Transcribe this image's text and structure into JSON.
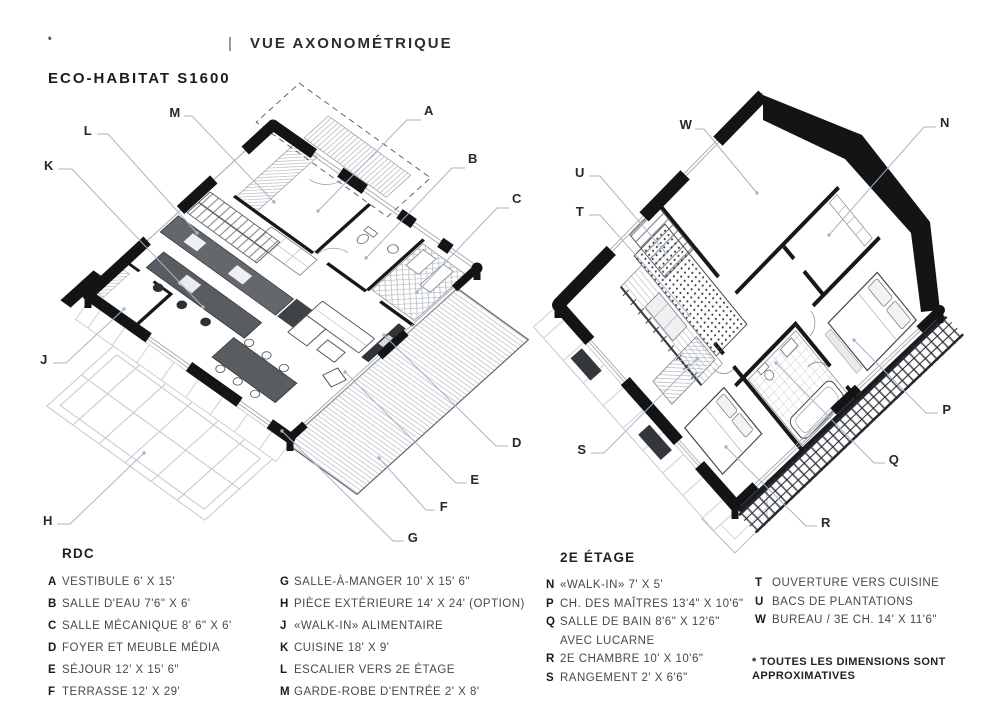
{
  "header": {
    "brand": "ECO-HABITAT S1600",
    "brand_sup": "*",
    "divider": "|",
    "view": "VUE AXONOMÉTRIQUE"
  },
  "captions": {
    "left": "RDC",
    "right": "2E ÉTAGE"
  },
  "legend": {
    "columns": [
      {
        "items": [
          {
            "k": "A",
            "t": "VESTIBULE 6' X 15'"
          },
          {
            "k": "B",
            "t": "SALLE D'EAU 7'6\" X 6'"
          },
          {
            "k": "C",
            "t": "SALLE MÉCANIQUE 8' 6\" X 6'"
          },
          {
            "k": "D",
            "t": "FOYER ET MEUBLE MÉDIA"
          },
          {
            "k": "E",
            "t": "SÉJOUR 12' X 15' 6\""
          },
          {
            "k": "F",
            "t": "TERRASSE 12' X 29'"
          }
        ]
      },
      {
        "items": [
          {
            "k": "G",
            "t": "SALLE-À-MANGER 10' X 15' 6\""
          },
          {
            "k": "H",
            "t": "PIÈCE EXTÉRIEURE 14' X 24' (OPTION)"
          },
          {
            "k": "J",
            "t": "«WALK-IN» ALIMENTAIRE"
          },
          {
            "k": "K",
            "t": "CUISINE 18' X 9'"
          },
          {
            "k": "L",
            "t": "ESCALIER VERS 2E ÉTAGE"
          },
          {
            "k": "M",
            "t": "GARDE-ROBE D'ENTRÉE 2' X 8'"
          }
        ]
      },
      {
        "items": [
          {
            "k": "N",
            "t": "«WALK-IN» 7' X 5'"
          },
          {
            "k": "P",
            "t": "CH. DES MAÎTRES 13'4\" X 10'6\""
          },
          {
            "k": "Q",
            "t": "SALLE DE BAIN 8'6\" X 12'6\""
          },
          {
            "k": "",
            "t": "AVEC LUCARNE"
          },
          {
            "k": "R",
            "t": "2E CHAMBRE 10' X 10'6\""
          },
          {
            "k": "S",
            "t": "RANGEMENT 2' X 6'6\""
          }
        ]
      },
      {
        "items": [
          {
            "k": "T",
            "t": "OUVERTURE VERS CUISINE"
          },
          {
            "k": "U",
            "t": "BACS DE PLANTATIONS"
          },
          {
            "k": "W",
            "t": "BUREAU / 3E CH. 14' X 11'6\""
          }
        ]
      }
    ]
  },
  "footnote": {
    "line1": "* TOUTES LES DIMENSIONS SONT",
    "line2": "APPROXIMATIVES"
  },
  "colors": {
    "leader": "#a7b5c8",
    "wall": "#131416",
    "furniture": "#5c6064"
  },
  "labels": {
    "left": [
      {
        "letter": "A",
        "label": [
          429,
          111
        ],
        "line": [
          [
            421,
            120
          ],
          [
            407,
            120
          ],
          [
            318,
            211
          ]
        ]
      },
      {
        "letter": "B",
        "label": [
          473,
          159
        ],
        "line": [
          [
            465,
            168
          ],
          [
            452,
            168
          ],
          [
            366,
            258
          ]
        ]
      },
      {
        "letter": "C",
        "label": [
          517,
          199
        ],
        "line": [
          [
            509,
            208
          ],
          [
            497,
            208
          ],
          [
            417,
            292
          ]
        ]
      },
      {
        "letter": "D",
        "label": [
          517,
          443
        ],
        "line": [
          [
            508,
            446
          ],
          [
            496,
            446
          ],
          [
            384,
            335
          ]
        ]
      },
      {
        "letter": "E",
        "label": [
          475,
          480
        ],
        "line": [
          [
            466,
            483
          ],
          [
            456,
            483
          ],
          [
            345,
            372
          ]
        ]
      },
      {
        "letter": "F",
        "label": [
          444,
          507
        ],
        "line": [
          [
            435,
            510
          ],
          [
            426,
            510
          ],
          [
            379,
            458
          ]
        ]
      },
      {
        "letter": "G",
        "label": [
          413,
          538
        ],
        "line": [
          [
            404,
            541
          ],
          [
            393,
            541
          ],
          [
            282,
            431
          ]
        ]
      },
      {
        "letter": "H",
        "label": [
          48,
          521
        ],
        "line": [
          [
            57,
            524
          ],
          [
            70,
            524
          ],
          [
            144,
            453
          ]
        ]
      },
      {
        "letter": "J",
        "label": [
          44,
          360
        ],
        "line": [
          [
            53,
            363
          ],
          [
            66,
            363
          ],
          [
            124,
            309
          ]
        ]
      },
      {
        "letter": "K",
        "label": [
          49,
          166
        ],
        "line": [
          [
            58,
            169
          ],
          [
            72,
            169
          ],
          [
            203,
            307
          ]
        ]
      },
      {
        "letter": "L",
        "label": [
          88,
          131
        ],
        "line": [
          [
            97,
            134
          ],
          [
            108,
            134
          ],
          [
            197,
            233
          ]
        ]
      },
      {
        "letter": "M",
        "label": [
          175,
          113
        ],
        "line": [
          [
            184,
            116
          ],
          [
            192,
            116
          ],
          [
            274,
            202
          ]
        ]
      }
    ],
    "right": [
      {
        "letter": "N",
        "label": [
          945,
          123
        ],
        "line": [
          [
            936,
            127
          ],
          [
            924,
            127
          ],
          [
            829,
            235
          ]
        ]
      },
      {
        "letter": "P",
        "label": [
          947,
          410
        ],
        "line": [
          [
            938,
            413
          ],
          [
            926,
            413
          ],
          [
            854,
            340
          ]
        ]
      },
      {
        "letter": "Q",
        "label": [
          894,
          460
        ],
        "line": [
          [
            885,
            463
          ],
          [
            874,
            463
          ],
          [
            776,
            363
          ]
        ]
      },
      {
        "letter": "R",
        "label": [
          826,
          523
        ],
        "line": [
          [
            817,
            526
          ],
          [
            806,
            526
          ],
          [
            726,
            447
          ]
        ]
      },
      {
        "letter": "S",
        "label": [
          582,
          450
        ],
        "line": [
          [
            591,
            453
          ],
          [
            604,
            453
          ],
          [
            697,
            359
          ]
        ]
      },
      {
        "letter": "T",
        "label": [
          580,
          212
        ],
        "line": [
          [
            589,
            215
          ],
          [
            600,
            215
          ],
          [
            689,
            315
          ]
        ]
      },
      {
        "letter": "U",
        "label": [
          580,
          173
        ],
        "line": [
          [
            589,
            176
          ],
          [
            600,
            176
          ],
          [
            666,
            253
          ]
        ]
      },
      {
        "letter": "W",
        "label": [
          686,
          125
        ],
        "line": [
          [
            695,
            129
          ],
          [
            704,
            129
          ],
          [
            757,
            193
          ]
        ]
      }
    ]
  }
}
